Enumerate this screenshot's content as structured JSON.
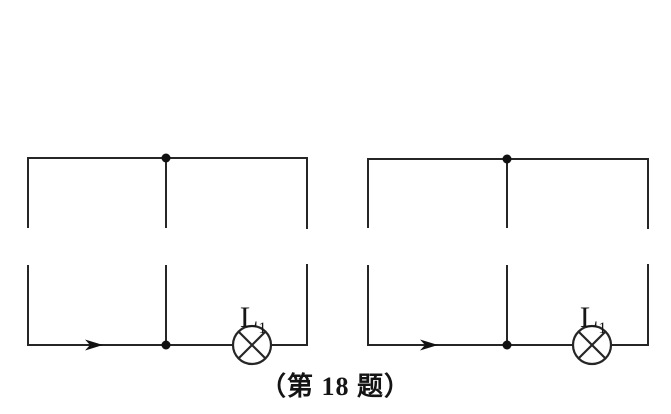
{
  "figure": {
    "background_color": "#ffffff",
    "line_color": "#262626",
    "caption": "（第 18 题）"
  },
  "circuits": [
    {
      "name": "left-circuit",
      "lamp": {
        "label_main": "L",
        "label_sub": "1"
      },
      "current_arrow_direction": "right",
      "junction_dots": 2,
      "open_gaps": 3
    },
    {
      "name": "right-circuit",
      "lamp": {
        "label_main": "L",
        "label_sub": "1"
      },
      "current_arrow_direction": "right",
      "junction_dots": 2,
      "open_gaps": 3
    }
  ]
}
